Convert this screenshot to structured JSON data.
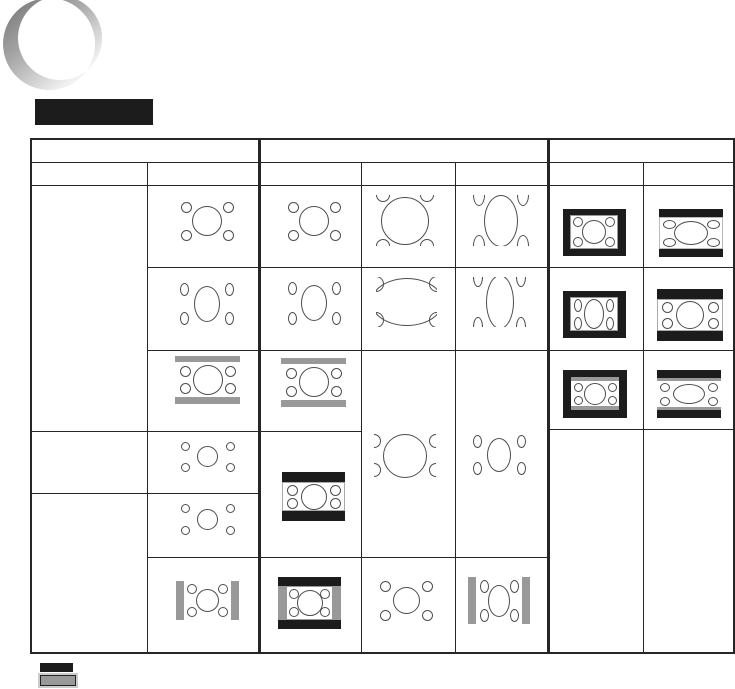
{
  "colors": {
    "black": "#1c1c1c",
    "line": "#262626",
    "bar_gray": "#999999",
    "pattern_stroke": "#4d4d4d",
    "crescent_gray": "#7d7d7d"
  },
  "decor": {
    "title_block": {
      "x": 35,
      "y": 99,
      "w": 118,
      "h": 26
    },
    "crescent": {
      "outer_cx": 49,
      "outer_cy": 44,
      "outer_r": 46,
      "inner_cx": 60,
      "inner_cy": 38,
      "inner_r": 42
    }
  },
  "table": {
    "v_lines": [
      {
        "x": 30,
        "y1": 138,
        "y2": 654,
        "w": 2
      },
      {
        "x": 147,
        "y1": 162,
        "y2": 653,
        "w": 1.4
      },
      {
        "x": 258,
        "y1": 138,
        "y2": 653,
        "w": 3
      },
      {
        "x": 361,
        "y1": 162,
        "y2": 653,
        "w": 1.4
      },
      {
        "x": 455,
        "y1": 162,
        "y2": 653,
        "w": 1.4
      },
      {
        "x": 547,
        "y1": 138,
        "y2": 653,
        "w": 3
      },
      {
        "x": 643,
        "y1": 162,
        "y2": 653,
        "w": 1.4
      },
      {
        "x": 733,
        "y1": 138,
        "y2": 653,
        "w": 2
      }
    ],
    "h_lines": [
      {
        "y": 138,
        "x1": 30,
        "x2": 735,
        "h": 2.4
      },
      {
        "y": 162,
        "x1": 30,
        "x2": 735,
        "h": 1.4
      },
      {
        "y": 185,
        "x1": 30,
        "x2": 735,
        "h": 1.4
      },
      {
        "y": 267,
        "x1": 147,
        "x2": 735,
        "h": 1.4
      },
      {
        "y": 350,
        "x1": 147,
        "x2": 735,
        "h": 1.4
      },
      {
        "y": 431,
        "x1": 30,
        "x2": 361,
        "h": 1.4
      },
      {
        "y": 429,
        "x1": 547,
        "x2": 735,
        "h": 1.4
      },
      {
        "y": 493,
        "x1": 30,
        "x2": 259,
        "h": 1.4
      },
      {
        "y": 557,
        "x1": 147,
        "x2": 549,
        "h": 1.4
      },
      {
        "y": 652,
        "x1": 30,
        "x2": 735,
        "h": 2
      }
    ]
  },
  "diagrams": [
    {
      "id": "a1",
      "x": 175,
      "y": 197,
      "w": 64,
      "h": 48,
      "ob": "#a8a8a8",
      "center": {
        "rx": 15,
        "ry": 15
      },
      "corner": {
        "rx": 5.5,
        "ry": 5.5,
        "ox": 11,
        "oy": 10
      }
    },
    {
      "id": "b1",
      "x": 282,
      "y": 197,
      "w": 64,
      "h": 48,
      "ob": "#a8a8a8",
      "center": {
        "rx": 15,
        "ry": 15
      },
      "corner": {
        "rx": 5.5,
        "ry": 5.5,
        "ox": 11,
        "oy": 10
      }
    },
    {
      "id": "c1",
      "x": 373,
      "y": 195,
      "w": 64,
      "h": 51,
      "ob": "#666666",
      "center": {
        "rx": 24,
        "ry": 24
      },
      "corner": {
        "rx": 7,
        "ry": 7,
        "ox": 10,
        "oy": 0
      }
    },
    {
      "id": "d1",
      "x": 470,
      "y": 195,
      "w": 62,
      "h": 51,
      "ob": "#666666",
      "center": {
        "rx": 17,
        "ry": 26
      },
      "corner": {
        "rx": 6,
        "ry": 11,
        "ox": 9,
        "oy": 0
      }
    },
    {
      "id": "e1",
      "x": 563,
      "y": 209,
      "w": 63,
      "h": 47,
      "frame": {
        "t": 6,
        "b": 7,
        "l": 7,
        "r": 8
      },
      "pb": "#999999",
      "center": {
        "rx": 12,
        "ry": 12
      },
      "corner": {
        "rx": 5,
        "ry": 5,
        "ox": 8,
        "oy": 7
      }
    },
    {
      "id": "f1",
      "x": 659,
      "y": 209,
      "w": 64,
      "h": 48,
      "frame": {
        "t": 8,
        "b": 8
      },
      "pb": "#bbbbbb",
      "center": {
        "rx": 17,
        "ry": 12
      },
      "corner": {
        "rx": 6.5,
        "ry": 4.5,
        "ox": 10,
        "oy": 7
      }
    },
    {
      "id": "a2",
      "x": 174,
      "y": 278,
      "w": 65,
      "h": 51,
      "ob": "#b5b5b5",
      "center": {
        "rx": 13,
        "ry": 18
      },
      "corner": {
        "rx": 4.5,
        "ry": 6.5,
        "ox": 10,
        "oy": 11
      }
    },
    {
      "id": "b2",
      "x": 282,
      "y": 277,
      "w": 64,
      "h": 52,
      "ob": "#b5b5b5",
      "center": {
        "rx": 13,
        "ry": 18
      },
      "corner": {
        "rx": 4.5,
        "ry": 6.5,
        "ox": 10,
        "oy": 11
      }
    },
    {
      "id": "c2",
      "x": 376,
      "y": 277,
      "w": 61,
      "h": 50,
      "ob": "#333333",
      "center": {
        "rx": 36,
        "ry": 24
      },
      "corner": {
        "rx": 8,
        "ry": 8,
        "ox": 0,
        "oy": 7
      }
    },
    {
      "id": "d2",
      "x": 469,
      "y": 277,
      "w": 61,
      "h": 50,
      "ob": "#333333",
      "center": {
        "rx": 14,
        "ry": 27
      },
      "corner": {
        "rx": 5,
        "ry": 10,
        "ox": 9,
        "oy": 0
      }
    },
    {
      "id": "e2",
      "x": 563,
      "y": 291,
      "w": 63,
      "h": 47,
      "frame": {
        "t": 6,
        "b": 7,
        "l": 7,
        "r": 8
      },
      "pb": "#999999",
      "center": {
        "rx": 10,
        "ry": 15
      },
      "corner": {
        "rx": 4,
        "ry": 6.5,
        "ox": 8,
        "oy": 8
      }
    },
    {
      "id": "f2",
      "x": 657,
      "y": 289,
      "w": 66,
      "h": 52,
      "frame": {
        "t": 10,
        "b": 10
      },
      "pb": "#aaaaaa",
      "center": {
        "rx": 14,
        "ry": 14
      },
      "corner": {
        "rx": 5.5,
        "ry": 5.5,
        "ox": 10,
        "oy": 8
      }
    },
    {
      "id": "a3",
      "x": 175,
      "y": 356,
      "w": 65,
      "h": 48,
      "ob": "#555555",
      "gray": {
        "t": 6,
        "b": 7
      },
      "center": {
        "rx": 15,
        "ry": 15
      },
      "corner": {
        "rx": 5.5,
        "ry": 5.5,
        "ox": 10,
        "oy": 9
      }
    },
    {
      "id": "b3",
      "x": 281,
      "y": 358,
      "w": 65,
      "h": 49,
      "ob": "#555555",
      "gray": {
        "t": 6,
        "b": 7
      },
      "center": {
        "rx": 15,
        "ry": 15
      },
      "corner": {
        "rx": 5.5,
        "ry": 5.5,
        "ox": 10,
        "oy": 9
      }
    },
    {
      "id": "e3",
      "x": 563,
      "y": 370,
      "w": 64,
      "h": 48,
      "frame": {
        "t": 7,
        "b": 8,
        "l": 8,
        "r": 8
      },
      "gray": {
        "t": 4,
        "b": 4
      },
      "center": {
        "rx": 11,
        "ry": 11
      },
      "corner": {
        "rx": 4.5,
        "ry": 4.5,
        "ox": 7,
        "oy": 6
      }
    },
    {
      "id": "f3",
      "x": 657,
      "y": 370,
      "w": 64,
      "h": 48,
      "frame": {
        "t": 8,
        "b": 8
      },
      "gray": {
        "t": 3,
        "b": 3
      },
      "center": {
        "rx": 16,
        "ry": 10
      },
      "corner": {
        "rx": 5,
        "ry": 4.5,
        "ox": 8,
        "oy": 6
      }
    },
    {
      "id": "c3_5",
      "x": 374,
      "y": 432,
      "w": 62,
      "h": 47,
      "ob": "#444444",
      "center": {
        "rx": 22,
        "ry": 22
      },
      "corner": {
        "rx": 7,
        "ry": 7,
        "ox": 0,
        "oy": 9
      }
    },
    {
      "id": "d3_5",
      "x": 468,
      "y": 431,
      "w": 62,
      "h": 47,
      "ob": "#999999",
      "center": {
        "rx": 12,
        "ry": 17
      },
      "corner": {
        "rx": 4.5,
        "ry": 6.5,
        "ox": 9,
        "oy": 10
      }
    },
    {
      "id": "a4",
      "x": 176,
      "y": 439,
      "w": 63,
      "h": 35,
      "ob": "#a8a8a8",
      "center": {
        "rx": 10.5,
        "ry": 10.5
      },
      "corner": {
        "rx": 4.5,
        "ry": 4.5,
        "ox": 9,
        "oy": 7
      }
    },
    {
      "id": "b4_5",
      "x": 282,
      "y": 472,
      "w": 63,
      "h": 49,
      "frame": {
        "t": 10,
        "b": 10
      },
      "pb": "#aaaaaa",
      "center": {
        "rx": 13,
        "ry": 13
      },
      "corner": {
        "rx": 5.5,
        "ry": 5.5,
        "ox": 10,
        "oy": 8
      }
    },
    {
      "id": "a5",
      "x": 176,
      "y": 501,
      "w": 63,
      "h": 36,
      "ob": "#a8a8a8",
      "center": {
        "rx": 10.5,
        "ry": 10.5
      },
      "corner": {
        "rx": 4.5,
        "ry": 4.5,
        "ox": 9,
        "oy": 7
      }
    },
    {
      "id": "a6",
      "x": 176,
      "y": 581,
      "w": 63,
      "h": 39,
      "ob": "#444444",
      "gray": {
        "l": 8,
        "r": 8
      },
      "center": {
        "rx": 11.5,
        "ry": 11.5
      },
      "corner": {
        "rx": 5,
        "ry": 5,
        "ox": 8,
        "oy": 8
      }
    },
    {
      "id": "b6",
      "x": 278,
      "y": 577,
      "w": 63,
      "h": 52,
      "frame": {
        "t": 9,
        "b": 9
      },
      "gray": {
        "l": 8,
        "r": 8
      },
      "pb": "#999999",
      "center": {
        "rx": 13,
        "ry": 13
      },
      "corner": {
        "rx": 5,
        "ry": 5,
        "ox": 8,
        "oy": 8
      }
    },
    {
      "id": "c6",
      "x": 375,
      "y": 577,
      "w": 62,
      "h": 47,
      "ob": "#a8a8a8",
      "center": {
        "rx": 13.5,
        "ry": 13.5
      },
      "corner": {
        "rx": 5.5,
        "ry": 5.5,
        "ox": 10,
        "oy": 9
      }
    },
    {
      "id": "d6",
      "x": 468,
      "y": 577,
      "w": 62,
      "h": 47,
      "ob": "#444444",
      "gray": {
        "l": 8,
        "r": 8
      },
      "center": {
        "rx": 11,
        "ry": 16
      },
      "corner": {
        "rx": 4.5,
        "ry": 6.5,
        "ox": 8,
        "oy": 9
      }
    }
  ],
  "legend": {
    "black_swatch": {
      "x": 40,
      "y": 663,
      "w": 33,
      "h": 9
    },
    "gray_swatch": {
      "x": 40,
      "y": 675,
      "w": 36,
      "h": 11
    }
  }
}
